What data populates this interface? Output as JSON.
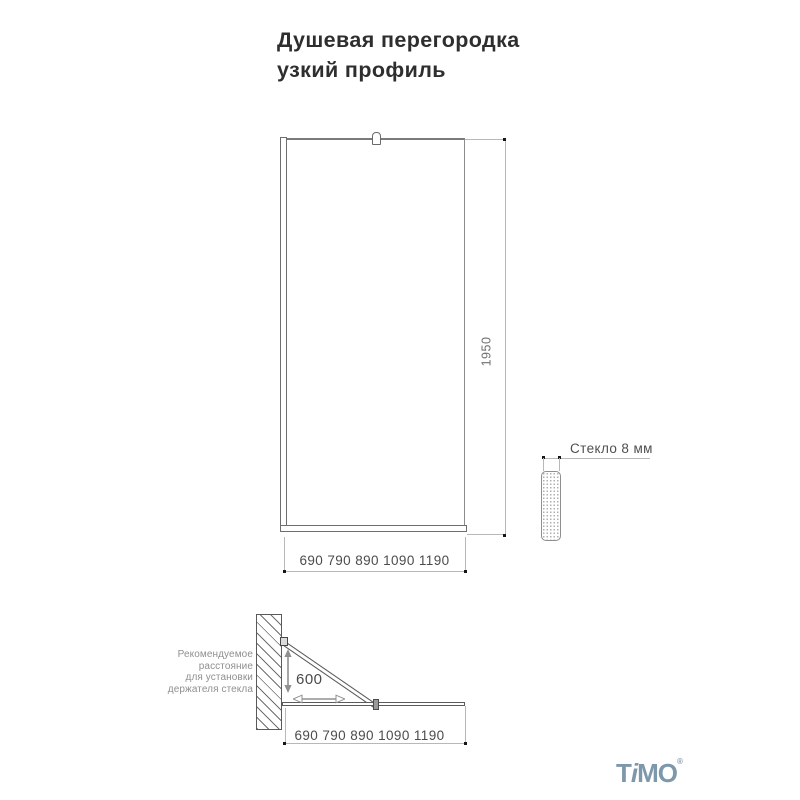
{
  "title": {
    "line1": "Душевая перегородка",
    "line2": "узкий профиль"
  },
  "front_view": {
    "height_dim": "1950",
    "width_dim": "690 790 890 1090 1190"
  },
  "glass_section": {
    "label": "Стекло 8 мм"
  },
  "plan_view": {
    "distance_dim": "600",
    "width_dim": "690 790 890 1090 1190",
    "note": {
      "line1": "Рекомендуемое",
      "line2": "расстояние",
      "line3": "для установки",
      "line4": "держателя стекла"
    }
  },
  "logo": {
    "t": "T",
    "i": "i",
    "mo": "MO",
    "reg": "®"
  },
  "colors": {
    "drawing_outline": "#6e6e6e",
    "dimension_line": "#b8b8b8",
    "dimension_text": "#4c4c4c",
    "note_text": "#8f8f8f",
    "arrow": "#909090",
    "logo": "#7d98aa",
    "background": "#ffffff"
  }
}
